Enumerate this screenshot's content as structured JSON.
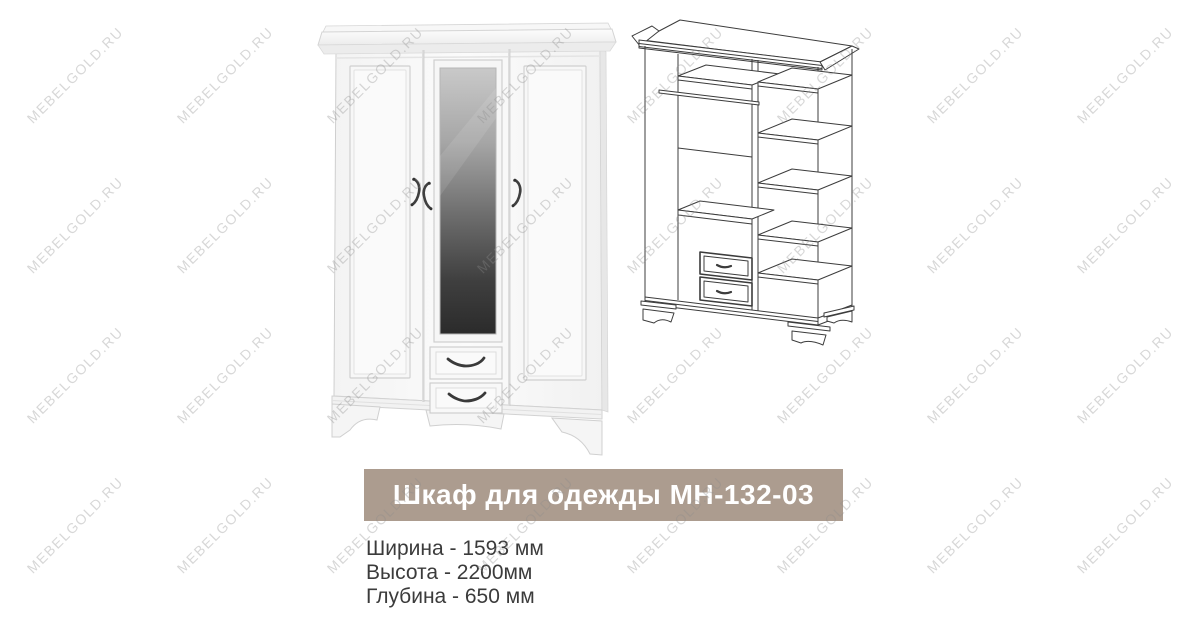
{
  "page": {
    "background": "#ffffff"
  },
  "banner": {
    "title": "Шкаф для одежды МН-132-03",
    "background": "#ac9c8f",
    "text_color": "#ffffff"
  },
  "specs": {
    "text_color": "#3b3b3b",
    "lines": [
      "Ширина - 1593 мм",
      "Высота - 2200мм",
      "Глубина - 650 мм"
    ]
  },
  "watermark": {
    "text": "MEBELGOLD.RU",
    "color": "#8c8c8c",
    "opacity": 0.34,
    "rotation_deg": -45,
    "grid": {
      "cols": 8,
      "rows": 4,
      "spacing_x": 150,
      "spacing_y": 150,
      "start_x": 75,
      "start_y": 75
    }
  },
  "illustrations": {
    "photo_name": "wardrobe-photo",
    "diagram_name": "wardrobe-interior-diagram"
  }
}
